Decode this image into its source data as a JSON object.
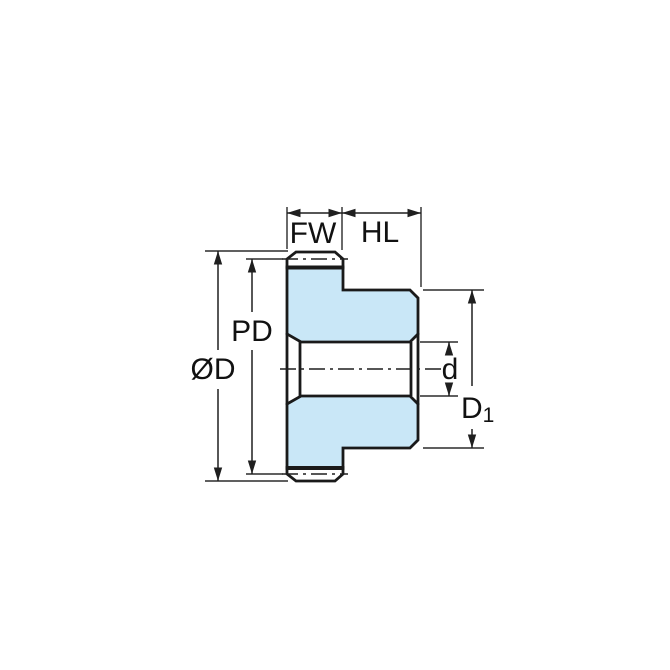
{
  "diagram": {
    "type": "technical-drawing",
    "subject": "spur-gear-with-hub-cross-section",
    "labels": {
      "face_width": "FW",
      "hub_length": "HL",
      "pitch_diameter": "PD",
      "outer_diameter": "ØD",
      "bore_diameter": "d",
      "hub_diameter_main": "D",
      "hub_diameter_sub": "1"
    },
    "colors": {
      "gear_fill": "#c9e7f7",
      "tooth_fill": "#ffffff",
      "outline": "#1a1a1a",
      "dimension_lines": "#2b2b2b",
      "background": "#ffffff"
    }
  }
}
